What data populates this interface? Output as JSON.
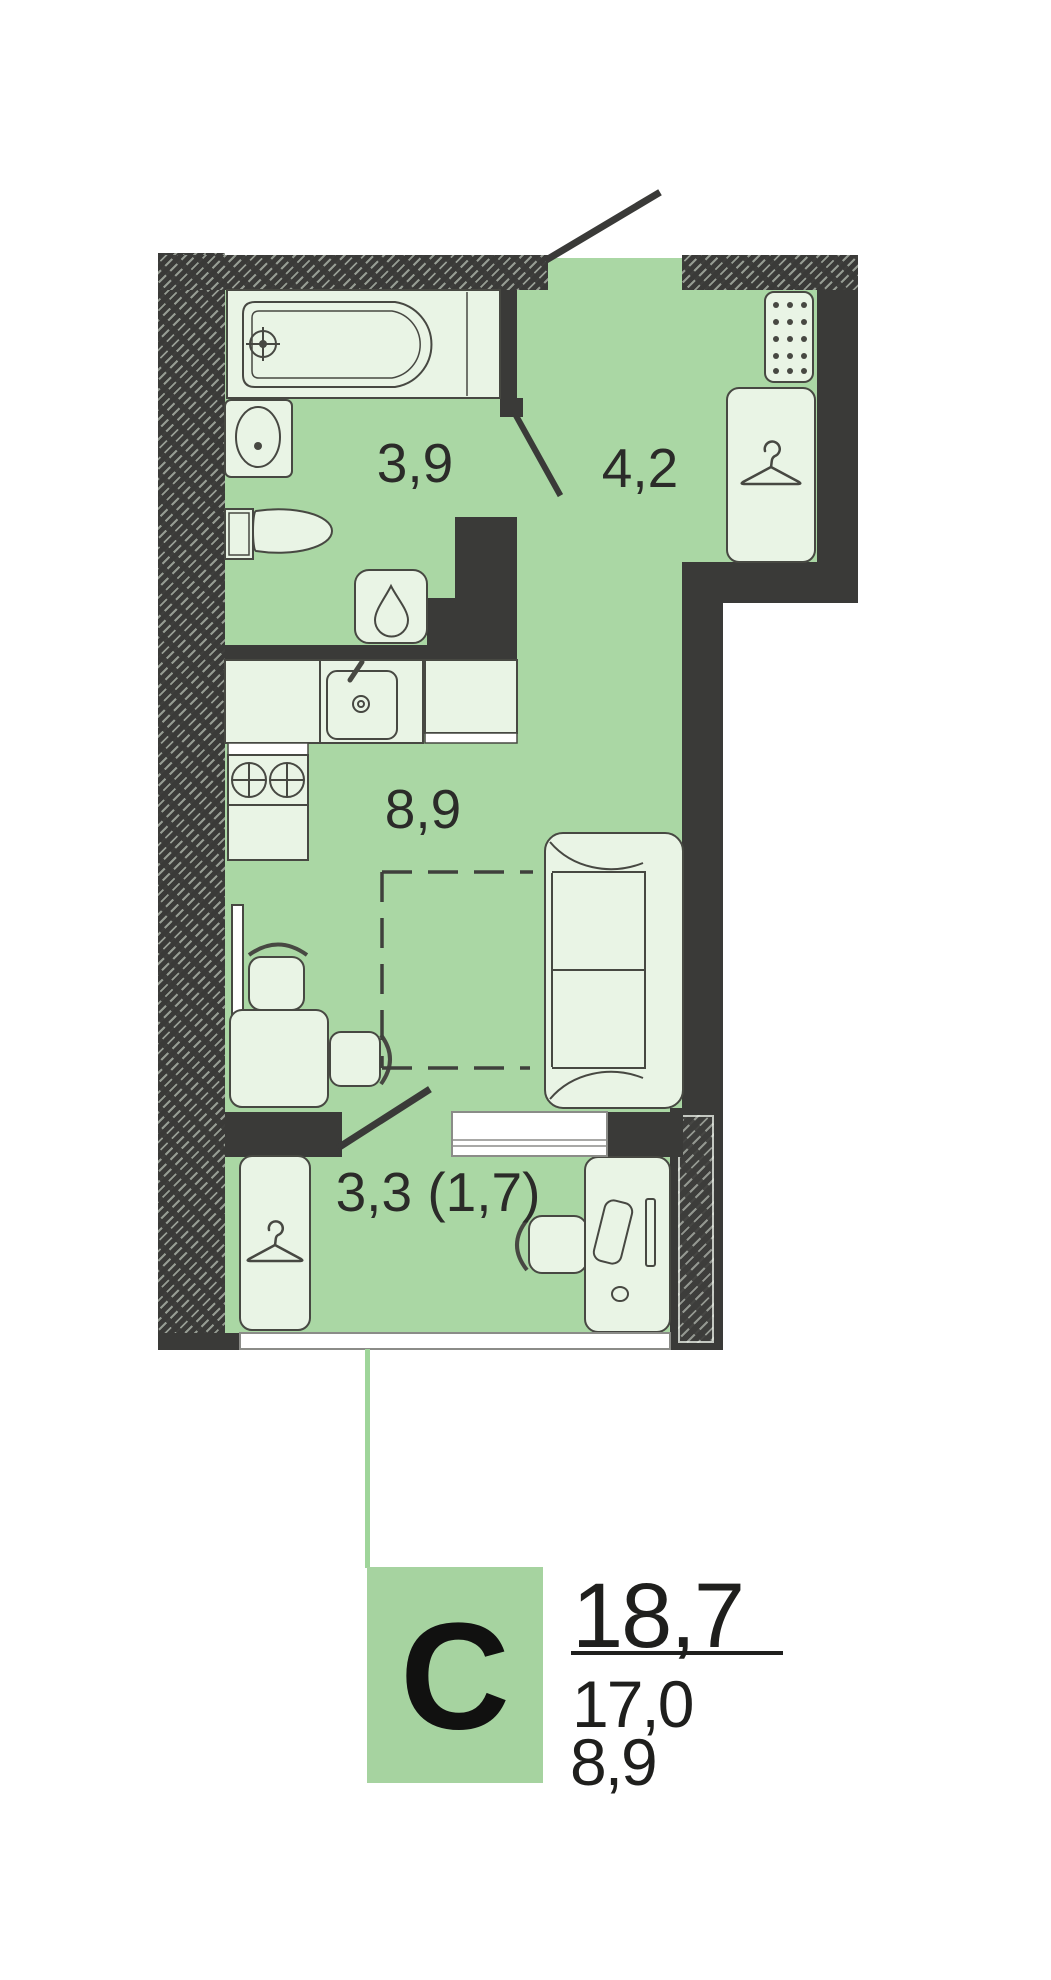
{
  "floorplan": {
    "rooms": [
      {
        "id": "bathroom",
        "area": "3,9"
      },
      {
        "id": "hallway",
        "area": "4,2"
      },
      {
        "id": "living-room-kitchen",
        "area": "8,9"
      },
      {
        "id": "balcony",
        "area": "3,3 (1,7)"
      }
    ],
    "stamp": {
      "type_letter": "С",
      "total_area": "18,7",
      "area_no_balcony": "17,0",
      "living_area": "8,9"
    },
    "icons": [
      "bathtub-icon",
      "bath-sink-icon",
      "toilet-icon",
      "water-heater-drop-icon",
      "kitchen-sink-icon",
      "stove-burners-icon",
      "hanger-icon",
      "shoe-cabinet-dots-icon",
      "tv-icon",
      "desk-icon",
      "chair-icon",
      "sofa-icon",
      "bed-dashed-outline",
      "door-swing-line",
      "window-sill",
      "balcony-glazing"
    ],
    "colors": {
      "floor_green": "#aad7a4",
      "furniture_fill": "#e9f4e5",
      "wall_dark": "#3a3a38",
      "stamp_green": "#a6d3a0",
      "connector_green": "#9fd59a",
      "text": "#2b2b29"
    }
  }
}
